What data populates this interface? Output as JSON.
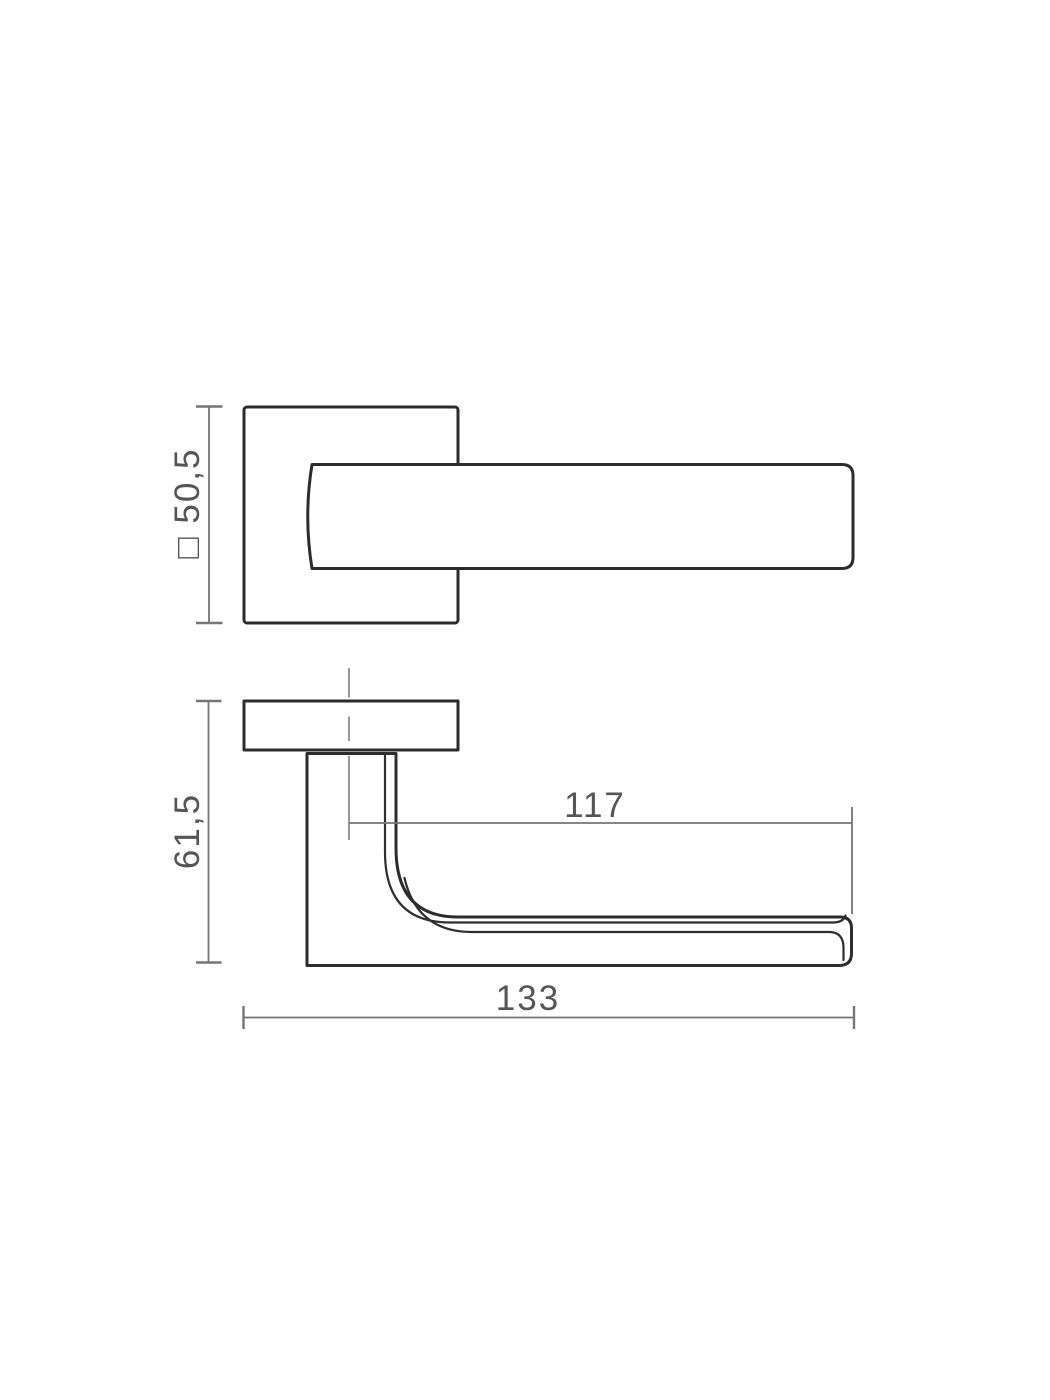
{
  "colors": {
    "background": "#ffffff",
    "part_outline": "#2b2c2e",
    "dimension_lines": "#747578",
    "centerline": "#8b8c8f",
    "dimension_text": "#545559"
  },
  "front_view": {
    "rose_dimension_label": "□ 50,5"
  },
  "side_view": {
    "height_dimension_label": "61,5",
    "grip_length_dimension_label": "117",
    "overall_length_dimension_label": "133"
  }
}
